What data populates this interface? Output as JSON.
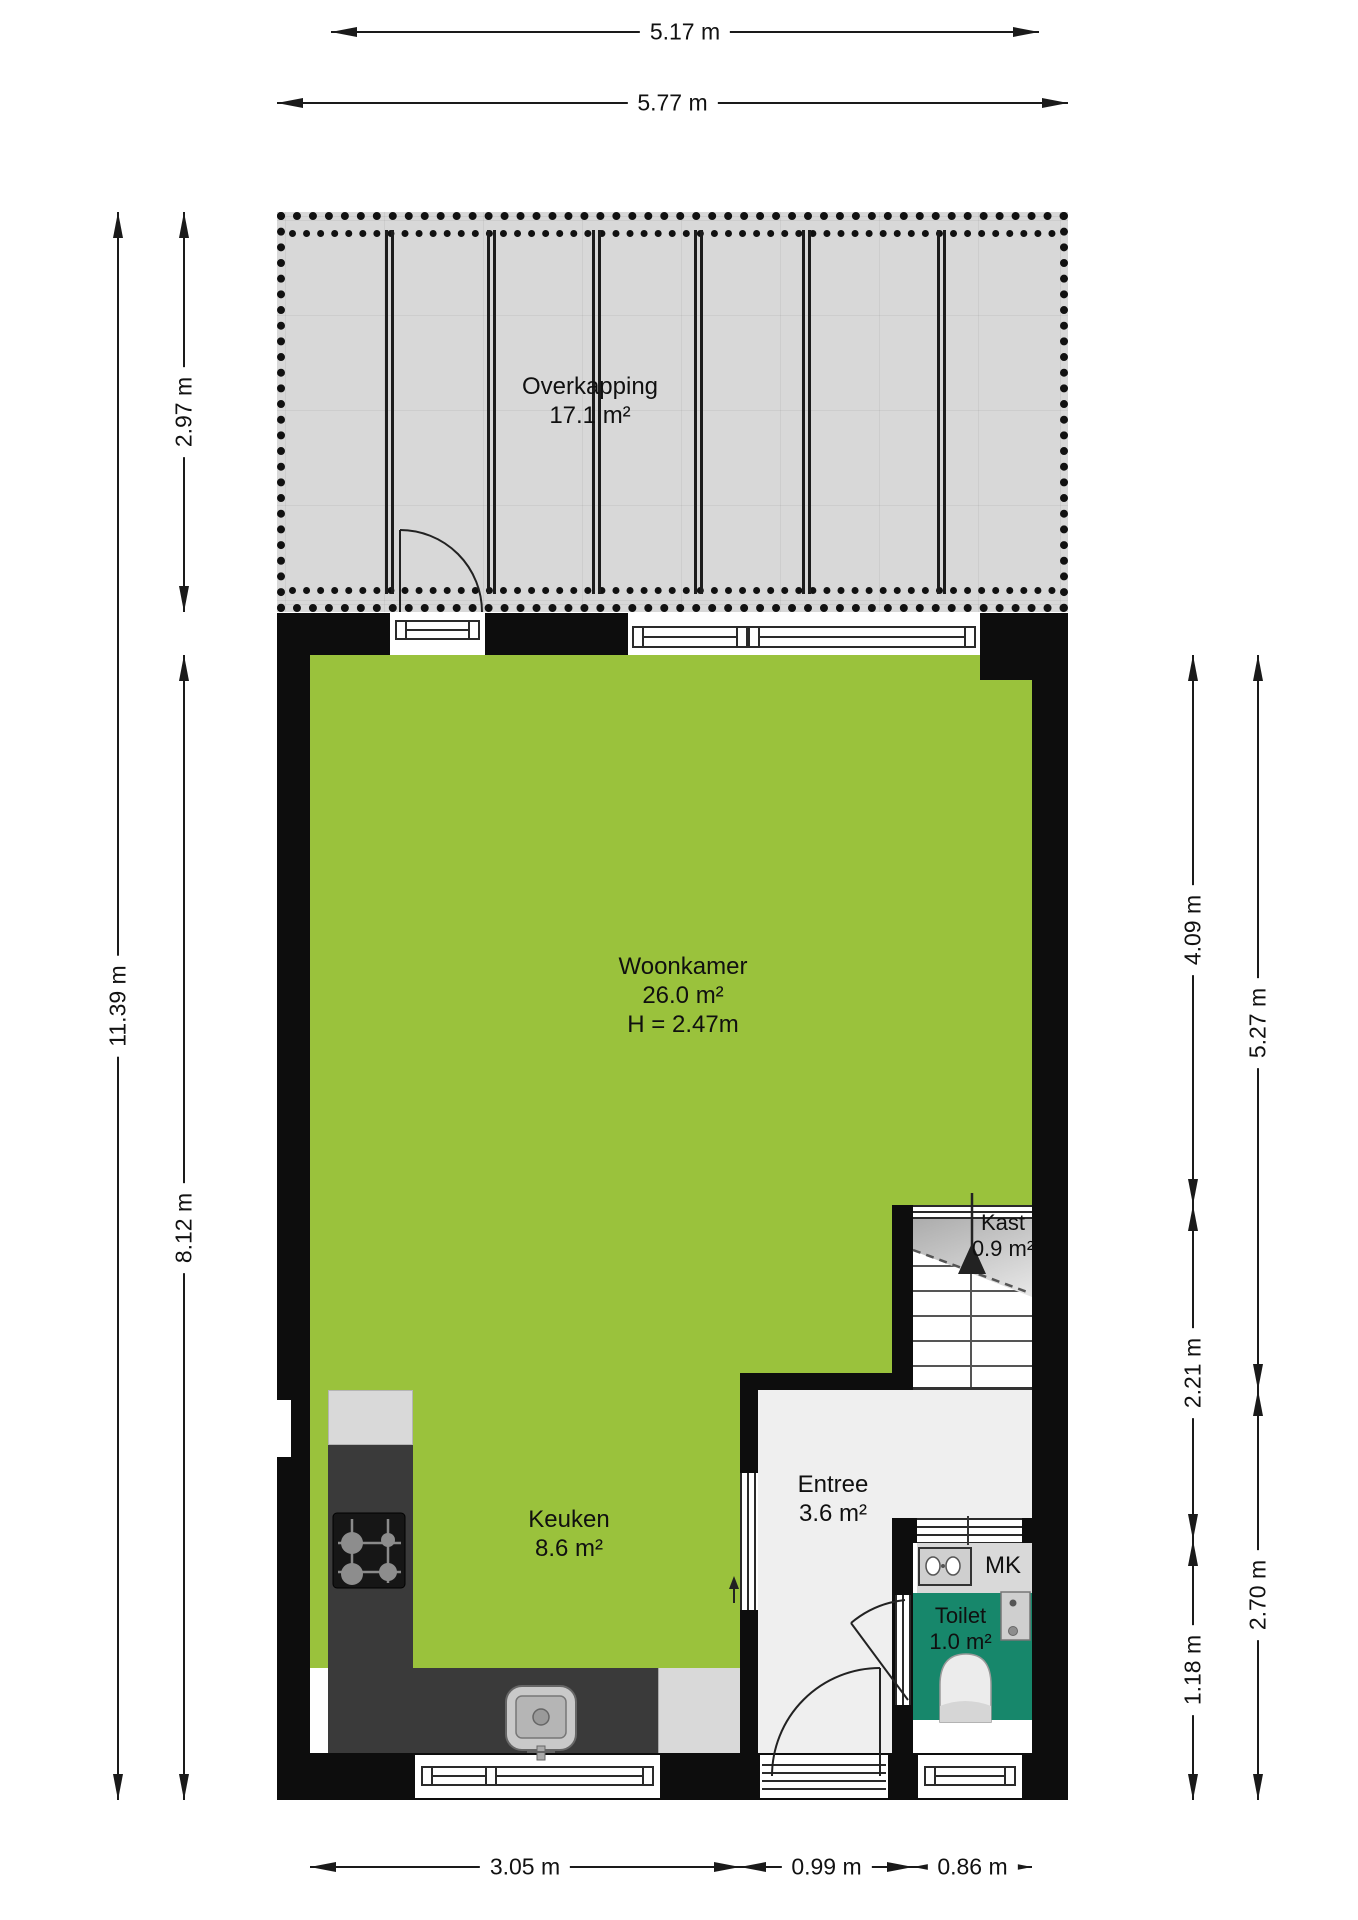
{
  "title": "Begane grond plattegrond",
  "rooms": {
    "overkapping": {
      "label": "Overkapping",
      "area": "17.1 m²"
    },
    "woonkamer": {
      "label": "Woonkamer",
      "area": "26.0 m²",
      "ceiling": "H = 2.47m"
    },
    "keuken": {
      "label": "Keuken",
      "area": "8.6 m²"
    },
    "entree": {
      "label": "Entree",
      "area": "3.6 m²"
    },
    "kast": {
      "label": "Kast",
      "area": "0.9 m²"
    },
    "toilet": {
      "label": "Toilet",
      "area": "1.0 m²"
    },
    "mk": {
      "label": "MK"
    }
  },
  "dimensions": {
    "top_inner": "5.17 m",
    "top_outer": "5.77 m",
    "left_outer": "11.39 m",
    "left_inner_top": "2.97 m",
    "left_inner_bottom": "8.12 m",
    "right_inner_top": "4.09 m",
    "right_inner_mid": "2.21 m",
    "right_inner_bottom": "1.18 m",
    "right_outer_top": "5.27 m",
    "right_outer_bottom": "2.70 m",
    "bottom_left": "3.05 m",
    "bottom_mid": "0.99 m",
    "bottom_right": "0.86 m"
  },
  "icons": {
    "stairs_direction": "up-arrow",
    "entree_direction": "up-arrow"
  },
  "colors": {
    "room_green": "#9ac23c",
    "toilet_teal": "#17876b",
    "canopy_gray": "#d8d8d8",
    "wall_black": "#0d0d0d",
    "counter_dark": "#3a3a3a",
    "appliance_gray": "#d9d9d9",
    "entree_floor": "#efefef"
  }
}
